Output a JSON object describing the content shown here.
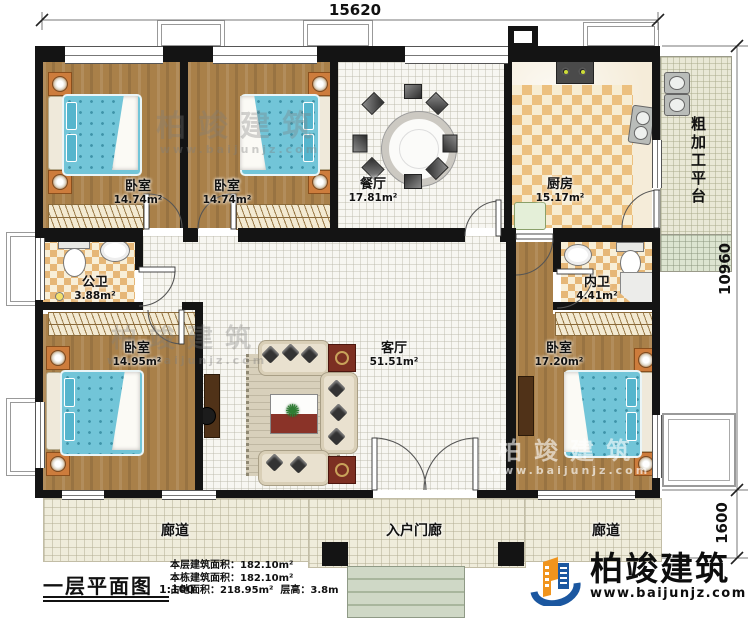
{
  "dims": {
    "top": "15620",
    "right": "10960",
    "porch": "1600"
  },
  "rooms": {
    "bedroom_tl": {
      "name": "卧室",
      "area": "14.74m²"
    },
    "bedroom_tm": {
      "name": "卧室",
      "area": "14.74m²"
    },
    "dining": {
      "name": "餐厅",
      "area": "17.81m²"
    },
    "kitchen": {
      "name": "厨房",
      "area": "15.17m²"
    },
    "platform": {
      "name": "粗加工平台"
    },
    "public_bath": {
      "name": "公卫",
      "area": "3.88m²"
    },
    "inner_bath": {
      "name": "内卫",
      "area": "4.41m²"
    },
    "bedroom_bl": {
      "name": "卧室",
      "area": "14.95m²"
    },
    "living": {
      "name": "客厅",
      "area": "51.51m²"
    },
    "bedroom_br": {
      "name": "卧室",
      "area": "17.20m²"
    },
    "corridor_left": {
      "name": "廊道"
    },
    "corridor_right": {
      "name": "廊道"
    },
    "porch": {
      "name": "入户门廊"
    }
  },
  "title_block": {
    "title": "一层平面图",
    "scale": "1:100",
    "stats": [
      {
        "label": "本层建筑面积：",
        "value": "182.10m²"
      },
      {
        "label": "本栋建筑面积：",
        "value": "182.10m²"
      },
      {
        "label": "占地面积：",
        "value": "218.95m²",
        "label2": "层高：",
        "value2": "3.8m"
      }
    ]
  },
  "brand": {
    "name": "柏竣建筑",
    "site": "www.baijunjz.com"
  },
  "watermark": {
    "name": "柏竣建筑",
    "site": "www.baijunjz.com"
  },
  "colors": {
    "brand_blue": "#1b57a0",
    "brand_orange": "#f0941d",
    "wall": "#141414",
    "mattress": "#72c5d8"
  }
}
